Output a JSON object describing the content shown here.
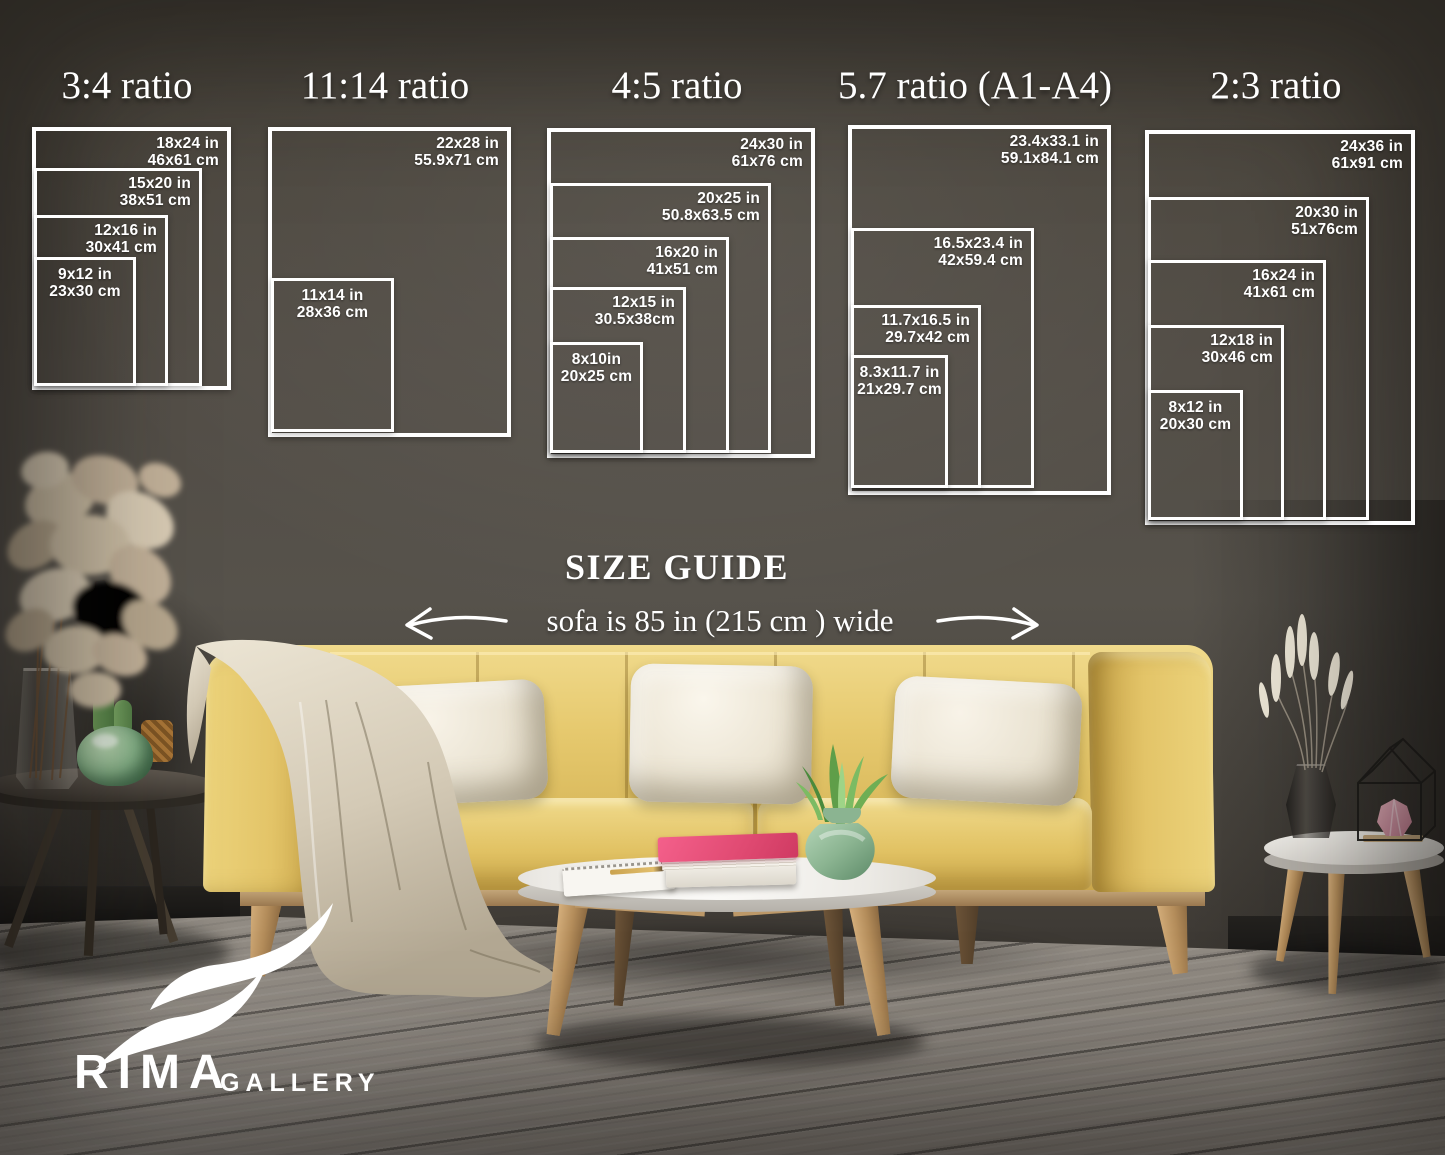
{
  "size_guide": {
    "heading": "SIZE GUIDE",
    "sofa_note": "sofa is 85 in (215 cm ) wide",
    "panels": [
      {
        "title": "3:4 ratio",
        "sizes": [
          {
            "inches": "18x24 in",
            "cm": "46x61 cm"
          },
          {
            "inches": "15x20 in",
            "cm": "38x51 cm"
          },
          {
            "inches": "12x16 in",
            "cm": "30x41 cm"
          },
          {
            "inches": "9x12 in",
            "cm": "23x30 cm"
          }
        ]
      },
      {
        "title": "11:14 ratio",
        "sizes": [
          {
            "inches": "22x28 in",
            "cm": "55.9x71 cm"
          },
          {
            "inches": "11x14 in",
            "cm": "28x36 cm"
          }
        ]
      },
      {
        "title": "4:5 ratio",
        "sizes": [
          {
            "inches": "24x30 in",
            "cm": "61x76 cm"
          },
          {
            "inches": "20x25 in",
            "cm": "50.8x63.5 cm"
          },
          {
            "inches": "16x20 in",
            "cm": "41x51 cm"
          },
          {
            "inches": "12x15 in",
            "cm": "30.5x38cm"
          },
          {
            "inches": "8x10in",
            "cm": "20x25 cm"
          }
        ]
      },
      {
        "title": "5.7 ratio (A1-A4)",
        "sizes": [
          {
            "inches": "23.4x33.1 in",
            "cm": "59.1x84.1 cm"
          },
          {
            "inches": "16.5x23.4 in",
            "cm": "42x59.4 cm"
          },
          {
            "inches": "11.7x16.5 in",
            "cm": "29.7x42 cm"
          },
          {
            "inches": "8.3x11.7 in",
            "cm": "21x29.7 cm"
          }
        ]
      },
      {
        "title": "2:3 ratio",
        "sizes": [
          {
            "inches": "24x36 in",
            "cm": "61x91 cm"
          },
          {
            "inches": "20x30 in",
            "cm": "51x76cm"
          },
          {
            "inches": "16x24 in",
            "cm": "41x61 cm"
          },
          {
            "inches": "12x18 in",
            "cm": "30x46 cm"
          },
          {
            "inches": "8x12 in",
            "cm": "20x30 cm"
          }
        ]
      }
    ]
  },
  "logo": {
    "brand": "RIMA",
    "suffix": "GALLERY"
  },
  "colors": {
    "frame_lines": "#ffffff",
    "overlay_text": "#ffffff",
    "wall": "#4e4a44",
    "floor": "#88837d",
    "sofa_yellow": "#e4c468",
    "pillow_cream": "#efe9db",
    "wood_legs": "#c8a273",
    "book_pink": "#ec4f7a",
    "vase_green": "#8fbf94",
    "blanket_beige": "#ddd4c2"
  }
}
